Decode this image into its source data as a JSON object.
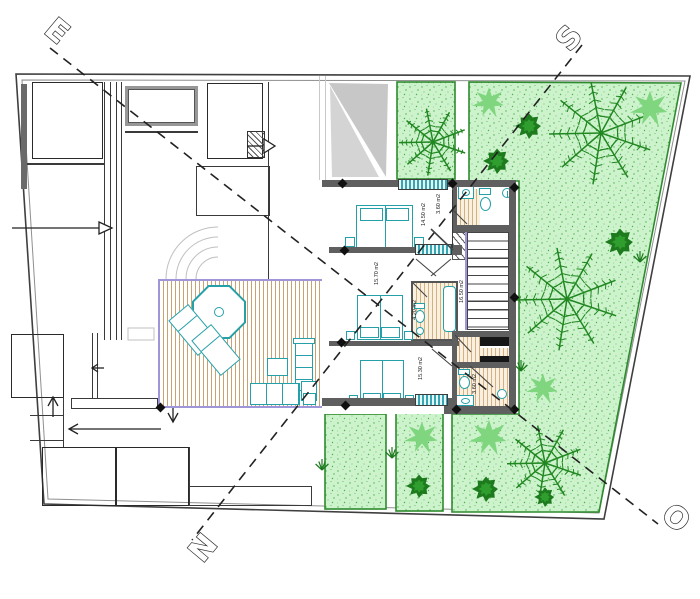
{
  "drawing": {
    "kind": "architectural floor plan, upper level with garden",
    "compass": {
      "e": "E",
      "s": "S",
      "n": "N",
      "o": "O"
    }
  },
  "room_labels": [
    {
      "id": "bedroom-1",
      "area": "14.50 m2",
      "x": 421,
      "y": 203
    },
    {
      "id": "bathroom-1",
      "area": "3.60 m2",
      "x": 436,
      "y": 194
    },
    {
      "id": "bedroom-2",
      "area": "15.70 m2",
      "x": 374,
      "y": 262
    },
    {
      "id": "ensuite-bathroom",
      "area": "4.20 m2",
      "x": 412,
      "y": 300
    },
    {
      "id": "hall-stairs",
      "area": "16.50 m2",
      "x": 459,
      "y": 280
    },
    {
      "id": "bedroom-3",
      "area": "15.30 m2",
      "x": 418,
      "y": 357
    },
    {
      "id": "bathroom-2",
      "area": "3.60 m2",
      "x": 472,
      "y": 374
    }
  ],
  "plants": [
    {
      "type": "palm",
      "x": 433,
      "y": 142,
      "r": 34
    },
    {
      "type": "palm",
      "x": 601,
      "y": 133,
      "r": 52
    },
    {
      "type": "palm",
      "x": 567,
      "y": 299,
      "r": 52
    },
    {
      "type": "palm",
      "x": 545,
      "y": 463,
      "r": 38
    },
    {
      "type": "star",
      "x": 489,
      "y": 102,
      "r": 16
    },
    {
      "type": "star",
      "x": 650,
      "y": 108,
      "r": 19
    },
    {
      "type": "star",
      "x": 422,
      "y": 437,
      "r": 17
    },
    {
      "type": "star",
      "x": 489,
      "y": 437,
      "r": 19
    },
    {
      "type": "star",
      "x": 543,
      "y": 388,
      "r": 16
    },
    {
      "type": "bush",
      "x": 529,
      "y": 126,
      "r": 13
    },
    {
      "type": "bush",
      "x": 497,
      "y": 161,
      "r": 13
    },
    {
      "type": "bush",
      "x": 620,
      "y": 242,
      "r": 14
    },
    {
      "type": "bush",
      "x": 419,
      "y": 486,
      "r": 12
    },
    {
      "type": "bush",
      "x": 486,
      "y": 489,
      "r": 13
    },
    {
      "type": "bush",
      "x": 545,
      "y": 497,
      "r": 10
    },
    {
      "type": "grass",
      "x": 322,
      "y": 470
    },
    {
      "type": "grass",
      "x": 392,
      "y": 458
    },
    {
      "type": "grass",
      "x": 521,
      "y": 371
    },
    {
      "type": "grass",
      "x": 640,
      "y": 262
    }
  ],
  "wall_markers": [
    [
      342,
      183
    ],
    [
      452,
      183
    ],
    [
      514,
      187
    ],
    [
      344,
      250
    ],
    [
      341,
      342
    ],
    [
      345,
      405
    ],
    [
      456,
      409
    ],
    [
      514,
      409
    ],
    [
      514,
      297
    ],
    [
      160,
      407
    ]
  ],
  "colors": {
    "teal_accent": "#26a0a8",
    "garden_green": "#cdf3cd",
    "garden_border": "#2e8b2e",
    "plant_dark": "#1d7a1d",
    "deck_tan": "#cba26e",
    "wall_gray": "#5f5f5f",
    "deck_border_purple": "#9e96d8",
    "sail_gray": "#c7c7c7"
  }
}
